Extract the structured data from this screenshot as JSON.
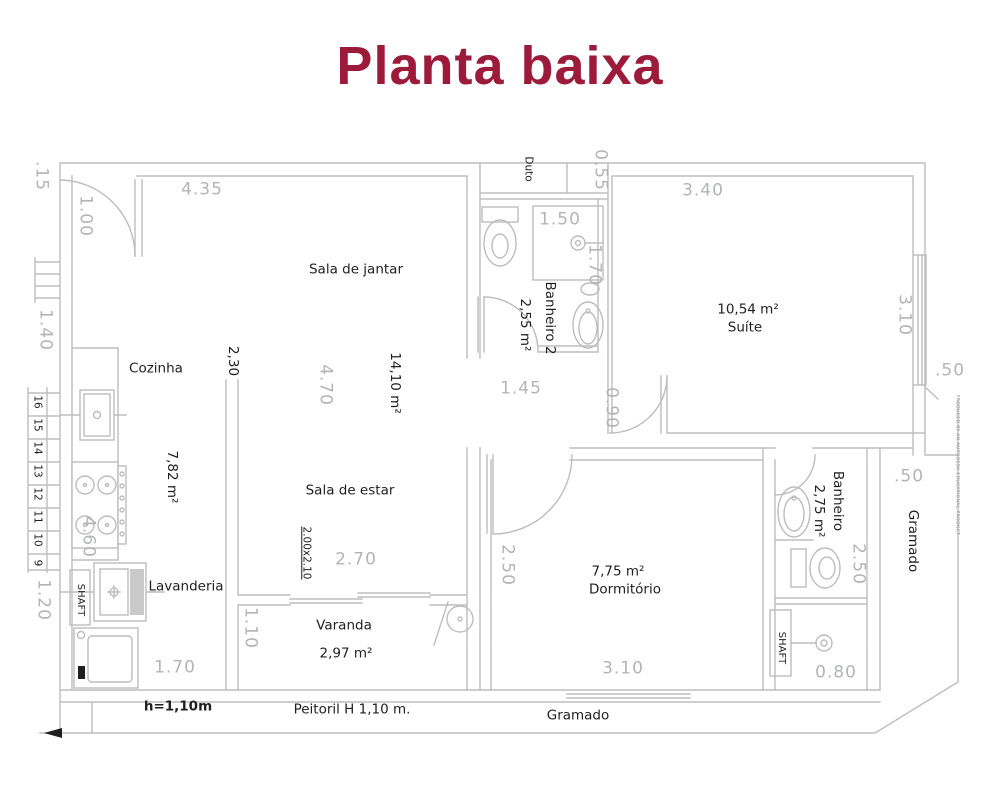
{
  "title": "Planta baixa",
  "colors": {
    "title": "#9c1b3a",
    "walls": "#bdbdbd",
    "dim_text": "#b3b5b5",
    "label_text": "#1f1f1f",
    "background": "#ffffff"
  },
  "rooms": {
    "sala_de_jantar": "Sala de jantar",
    "sala_de_estar": "Sala de estar",
    "sala_area": "14,10 m²",
    "cozinha": "Cozinha",
    "cozinha_area": "7,82 m²",
    "banheiro2": "Banheiro 2",
    "banheiro2_area": "2,55 m²",
    "duto": "Duto",
    "suite": "Suíte",
    "suite_area": "10,54 m²",
    "dormitorio": "Dormitório",
    "dormitorio_area": "7,75 m²",
    "banheiro": "Banheiro",
    "banheiro_area": "2,75 m²",
    "lavanderia": "Lavanderia",
    "varanda": "Varanda",
    "varanda_area": "2,97 m²",
    "shaft": "SHAFT",
    "gramado": "Gramado"
  },
  "dimensions": {
    "d435": "4.35",
    "d015": ".15",
    "d100": "1.00",
    "d140": "1.40",
    "d230": "2,30",
    "d470": "4.70",
    "d460": "4.60",
    "d120": "1.20",
    "d170_lavanderia": "1.70",
    "d110": "1.10",
    "d270": "2.70",
    "d150": "1.50",
    "d170_chuveiro": "1.70",
    "d055": "0,55",
    "d340": "3.40",
    "d310_suite": "3.10",
    "d145": "1.45",
    "d090": "0.90",
    "d250_dormitorio": "2.50",
    "d310_dormitorio": "3.10",
    "d250_banheiro": "2.50",
    "d080": "0.80",
    "d050": ".50"
  },
  "stairs": [
    "16",
    "15",
    "14",
    "13",
    "12",
    "11",
    "10",
    "9"
  ],
  "notes": {
    "muro_altura": "h=1,10m",
    "peitoril": "Peitoril H 1,10 m.",
    "porta_varanda": "2.00x2.10",
    "watermark": "PRODUCED BY AN AUTODESK EDUCATIONAL PRODUCT"
  }
}
